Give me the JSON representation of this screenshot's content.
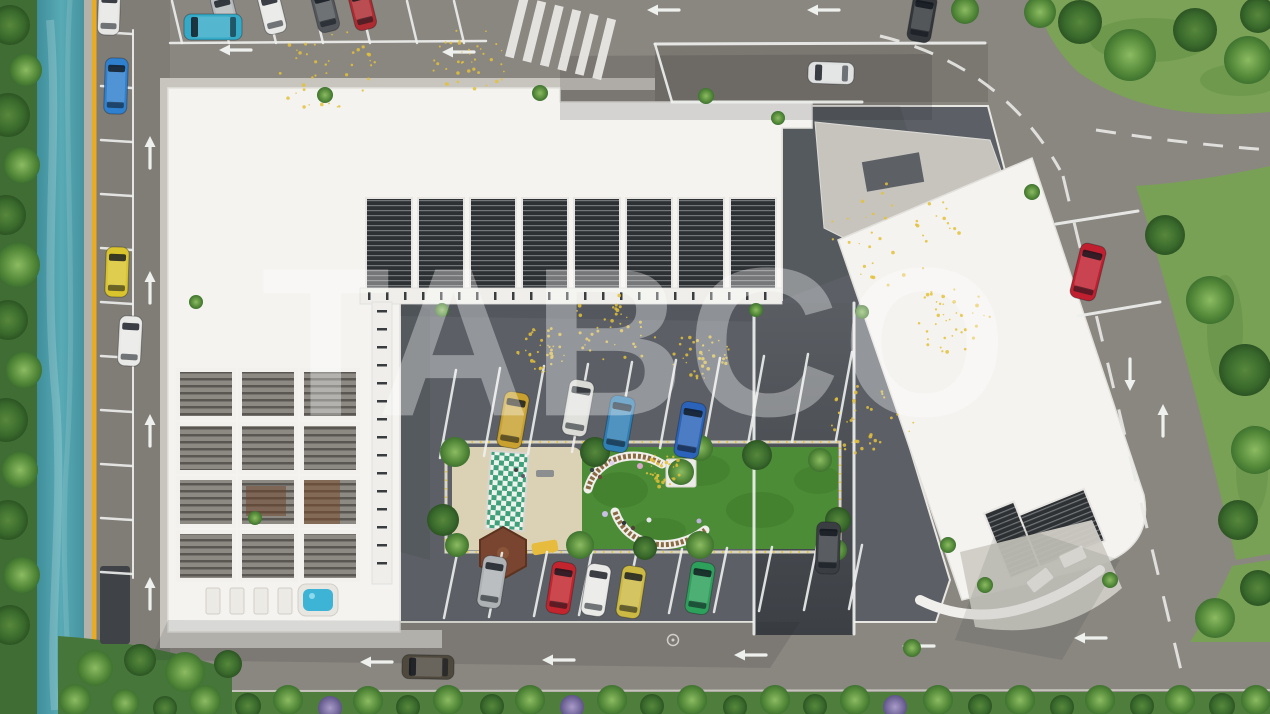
{
  "watermark": {
    "text": "TABCO"
  },
  "scene": {
    "description": "Aerial 3D architectural rendering: white residential complex with rooftop pergolas, inner courtyard parking, playground and garden, bordered by roads, a teal canal and greenery",
    "palette": {
      "road": "#8a8680",
      "courtyard_asphalt": "#5c6066",
      "ramp": "#4c5055",
      "roof_white": "#f4f3f0",
      "apron": "#c8c5be",
      "slats_dark": "#33363a",
      "water": "#4796a3",
      "barrier_yellow": "#e8ab21",
      "grass": "#7ba257",
      "vegetation": "#47763a",
      "lawn": "#4c8c36",
      "sand": "#dbd1b4",
      "line_white": "#eef0ee",
      "bench_wood": "#8a6a42",
      "jacuzzi": "#3db4d6",
      "confetti_yellow": "#e3c139"
    },
    "cars": [
      {
        "name": "parked-car-silver-top",
        "color": "#b7babc",
        "x": 225,
        "y": 14,
        "rot": -14,
        "l": 44,
        "w": 22
      },
      {
        "name": "parked-car-white-top",
        "color": "#e8e8e6",
        "x": 272,
        "y": 12,
        "rot": -14,
        "l": 44,
        "w": 22
      },
      {
        "name": "parked-car-gray-top",
        "color": "#53575b",
        "x": 325,
        "y": 10,
        "rot": -14,
        "l": 44,
        "w": 22
      },
      {
        "name": "parked-car-red-top",
        "color": "#ad2b31",
        "x": 362,
        "y": 8,
        "rot": -14,
        "l": 44,
        "w": 22
      },
      {
        "name": "parked-car-teal-top",
        "color": "#35a9c6",
        "x": 213,
        "y": 27,
        "rot": -90,
        "l": 58,
        "w": 26
      },
      {
        "name": "parked-car-white-topleft",
        "color": "#e6e6e4",
        "x": 109,
        "y": 12,
        "rot": 2,
        "l": 46,
        "w": 22
      },
      {
        "name": "parked-car-blue-left",
        "color": "#2f80cf",
        "x": 116,
        "y": 86,
        "rot": 2,
        "l": 56,
        "w": 23
      },
      {
        "name": "parked-car-yellow-left",
        "color": "#d9c42e",
        "x": 117,
        "y": 272,
        "rot": 2,
        "l": 50,
        "w": 23
      },
      {
        "name": "driving-car-white-left",
        "color": "#e9e9e7",
        "x": 130,
        "y": 341,
        "rot": 3,
        "l": 50,
        "w": 23
      },
      {
        "name": "driving-car-white-driveway",
        "color": "#dfe1e1",
        "x": 831,
        "y": 73,
        "rot": -88,
        "l": 46,
        "w": 22
      },
      {
        "name": "driving-suv-black-topright",
        "color": "#33373b",
        "x": 922,
        "y": 18,
        "rot": 10,
        "l": 48,
        "w": 24
      },
      {
        "name": "parked-car-red-right",
        "color": "#c01f2f",
        "x": 1088,
        "y": 272,
        "rot": 14,
        "l": 56,
        "w": 26
      },
      {
        "name": "driving-car-black-ramp",
        "color": "#3a3e43",
        "x": 828,
        "y": 548,
        "rot": 2,
        "l": 52,
        "w": 24
      },
      {
        "name": "driving-car-bronze-bottom",
        "color": "#4e483d",
        "x": 428,
        "y": 667,
        "rot": -89,
        "l": 52,
        "w": 24
      },
      {
        "name": "parked-car-gold-courtyard",
        "color": "#c8a130",
        "x": 513,
        "y": 420,
        "rot": 10,
        "l": 56,
        "w": 25
      },
      {
        "name": "parked-car-white-courtyard",
        "color": "#dadbd6",
        "x": 578,
        "y": 408,
        "rot": 10,
        "l": 56,
        "w": 25
      },
      {
        "name": "parked-car-steelblue-courtyard",
        "color": "#2f7fb4",
        "x": 619,
        "y": 424,
        "rot": 10,
        "l": 56,
        "w": 25
      },
      {
        "name": "parked-car-blue-courtyard",
        "color": "#2a63b9",
        "x": 690,
        "y": 430,
        "rot": 10,
        "l": 56,
        "w": 25
      },
      {
        "name": "parked-car-silver-courtyard",
        "color": "#aeb2b4",
        "x": 492,
        "y": 582,
        "rot": 9,
        "l": 52,
        "w": 24
      },
      {
        "name": "parked-car-red-courtyard",
        "color": "#c2252e",
        "x": 561,
        "y": 588,
        "rot": 9,
        "l": 52,
        "w": 24
      },
      {
        "name": "parked-car-white2-courtyard",
        "color": "#e9e9e7",
        "x": 596,
        "y": 590,
        "rot": 9,
        "l": 52,
        "w": 24
      },
      {
        "name": "parked-car-yellow-courtyard",
        "color": "#ccb944",
        "x": 631,
        "y": 592,
        "rot": 9,
        "l": 52,
        "w": 24
      },
      {
        "name": "parked-car-green-courtyard",
        "color": "#2da05b",
        "x": 700,
        "y": 588,
        "rot": 9,
        "l": 52,
        "w": 24
      }
    ],
    "trees": [
      [
        10,
        25,
        20,
        "d"
      ],
      [
        26,
        70,
        16,
        "m"
      ],
      [
        8,
        115,
        22,
        "d"
      ],
      [
        22,
        165,
        18,
        "m"
      ],
      [
        6,
        215,
        20,
        "d"
      ],
      [
        18,
        265,
        22,
        "m"
      ],
      [
        8,
        320,
        20,
        "d"
      ],
      [
        24,
        370,
        18,
        "m"
      ],
      [
        6,
        420,
        22,
        "d"
      ],
      [
        20,
        470,
        18,
        "m"
      ],
      [
        8,
        520,
        20,
        "d"
      ],
      [
        22,
        575,
        18,
        "m"
      ],
      [
        10,
        625,
        20,
        "d"
      ],
      [
        95,
        668,
        18,
        "m"
      ],
      [
        140,
        660,
        16,
        "d"
      ],
      [
        185,
        672,
        20,
        "m"
      ],
      [
        228,
        664,
        14,
        "d"
      ],
      [
        75,
        700,
        16,
        "m"
      ],
      [
        125,
        703,
        14,
        "m"
      ],
      [
        165,
        708,
        12,
        "d"
      ],
      [
        205,
        701,
        16,
        "m"
      ],
      [
        248,
        706,
        13,
        "d"
      ],
      [
        288,
        700,
        15,
        "m"
      ],
      [
        330,
        708,
        12,
        "p"
      ],
      [
        368,
        701,
        15,
        "m"
      ],
      [
        408,
        707,
        12,
        "d"
      ],
      [
        448,
        700,
        15,
        "m"
      ],
      [
        492,
        706,
        12,
        "d"
      ],
      [
        530,
        700,
        15,
        "m"
      ],
      [
        572,
        707,
        12,
        "p"
      ],
      [
        612,
        700,
        15,
        "m"
      ],
      [
        652,
        706,
        12,
        "d"
      ],
      [
        692,
        700,
        15,
        "m"
      ],
      [
        735,
        707,
        12,
        "d"
      ],
      [
        775,
        700,
        15,
        "m"
      ],
      [
        815,
        706,
        12,
        "d"
      ],
      [
        855,
        700,
        15,
        "m"
      ],
      [
        895,
        707,
        12,
        "p"
      ],
      [
        938,
        700,
        15,
        "m"
      ],
      [
        980,
        706,
        12,
        "d"
      ],
      [
        1020,
        700,
        15,
        "m"
      ],
      [
        1062,
        707,
        12,
        "d"
      ],
      [
        1100,
        700,
        15,
        "m"
      ],
      [
        1142,
        706,
        12,
        "d"
      ],
      [
        1180,
        700,
        15,
        "m"
      ],
      [
        1222,
        706,
        13,
        "d"
      ],
      [
        1256,
        700,
        15,
        "m"
      ],
      [
        1040,
        12,
        16,
        "m"
      ],
      [
        1080,
        22,
        22,
        "d"
      ],
      [
        1130,
        55,
        26,
        "m"
      ],
      [
        1195,
        30,
        22,
        "d"
      ],
      [
        1248,
        60,
        24,
        "m"
      ],
      [
        1258,
        15,
        18,
        "d"
      ],
      [
        965,
        10,
        14,
        "m"
      ],
      [
        1165,
        235,
        20,
        "d"
      ],
      [
        1210,
        300,
        24,
        "m"
      ],
      [
        1245,
        370,
        26,
        "d"
      ],
      [
        1255,
        450,
        24,
        "m"
      ],
      [
        1238,
        520,
        20,
        "d"
      ],
      [
        1215,
        618,
        20,
        "m"
      ],
      [
        1258,
        588,
        18,
        "d"
      ],
      [
        455,
        452,
        15,
        "m"
      ],
      [
        443,
        520,
        16,
        "d"
      ],
      [
        457,
        545,
        12,
        "m"
      ],
      [
        595,
        452,
        15,
        "d"
      ],
      [
        580,
        545,
        14,
        "m"
      ],
      [
        700,
        448,
        13,
        "m"
      ],
      [
        757,
        455,
        15,
        "d"
      ],
      [
        820,
        460,
        12,
        "m"
      ],
      [
        838,
        520,
        13,
        "d"
      ],
      [
        700,
        545,
        14,
        "m"
      ],
      [
        645,
        548,
        12,
        "d"
      ],
      [
        836,
        550,
        11,
        "m"
      ],
      [
        325,
        95,
        8,
        "m"
      ],
      [
        540,
        93,
        8,
        "m"
      ],
      [
        706,
        96,
        8,
        "m"
      ],
      [
        778,
        118,
        7,
        "m"
      ],
      [
        196,
        302,
        7,
        "m"
      ],
      [
        442,
        310,
        7,
        "m"
      ],
      [
        255,
        518,
        7,
        "m"
      ],
      [
        1032,
        192,
        8,
        "m"
      ],
      [
        948,
        545,
        8,
        "m"
      ],
      [
        912,
        648,
        9,
        "m"
      ],
      [
        756,
        310,
        7,
        "m"
      ],
      [
        862,
        312,
        7,
        "m"
      ],
      [
        985,
        585,
        8,
        "m"
      ],
      [
        1110,
        580,
        8,
        "m"
      ]
    ],
    "arrows": [
      {
        "x": 235,
        "y": 50,
        "dir": "left"
      },
      {
        "x": 458,
        "y": 52,
        "dir": "left"
      },
      {
        "x": 663,
        "y": 10,
        "dir": "left"
      },
      {
        "x": 823,
        "y": 10,
        "dir": "left"
      },
      {
        "x": 376,
        "y": 662,
        "dir": "left"
      },
      {
        "x": 558,
        "y": 660,
        "dir": "left"
      },
      {
        "x": 750,
        "y": 655,
        "dir": "left"
      },
      {
        "x": 918,
        "y": 646,
        "dir": "left"
      },
      {
        "x": 1090,
        "y": 638,
        "dir": "left"
      },
      {
        "x": 150,
        "y": 152,
        "dir": "up"
      },
      {
        "x": 150,
        "y": 287,
        "dir": "up"
      },
      {
        "x": 150,
        "y": 430,
        "dir": "up"
      },
      {
        "x": 150,
        "y": 593,
        "dir": "up"
      },
      {
        "x": 1163,
        "y": 420,
        "dir": "up"
      },
      {
        "x": 1130,
        "y": 375,
        "dir": "down"
      }
    ],
    "parking_rows": [
      {
        "name": "top-street-bays",
        "x0": 172,
        "y0": 1,
        "sx": 47,
        "sy": 0,
        "vx": 10,
        "vy": 42,
        "n": 7
      },
      {
        "name": "canal-street-bays",
        "x0": 101,
        "y0": 32,
        "sx": 0,
        "sy": 54,
        "vx": 31,
        "vy": 2,
        "n": 11
      },
      {
        "name": "courtyard-upper-bays",
        "x0": 440,
        "y0": 458,
        "sx": 44,
        "sy": -2,
        "vx": 16,
        "vy": -88,
        "n": 10
      },
      {
        "name": "courtyard-lower-bays",
        "x0": 444,
        "y0": 618,
        "sx": 45,
        "sy": -1,
        "vx": 13,
        "vy": -64,
        "n": 10
      }
    ],
    "lane_lines": [
      [
        170,
        43,
        486,
        41,
        2.5
      ],
      [
        133,
        30,
        133,
        578,
        2
      ],
      [
        1056,
        224,
        1138,
        211,
        3
      ],
      [
        1078,
        316,
        1160,
        302,
        3
      ],
      [
        655,
        44,
        985,
        43,
        3
      ],
      [
        672,
        102,
        862,
        102,
        3
      ],
      [
        655,
        44,
        672,
        102,
        2.5
      ],
      [
        754,
        303,
        754,
        634,
        3
      ],
      [
        854,
        303,
        854,
        634,
        3
      ]
    ],
    "dashed_paths": [
      {
        "d": "M880,36 Q1002,66 1060,170",
        "dash": "20 16",
        "w": 3
      },
      {
        "d": "M1063,176 L1190,708",
        "dash": "26 22",
        "w": 3
      },
      {
        "d": "M1096,130 Q1186,144 1270,150",
        "dash": "20 16",
        "w": 3
      }
    ],
    "zebra": {
      "x": 520,
      "y": -4,
      "rot": 14,
      "n": 6,
      "w": 9,
      "h": 62,
      "gap": 9
    },
    "speckle_clusters": [
      [
        330,
        70,
        55
      ],
      [
        470,
        60,
        40
      ],
      [
        610,
        330,
        48
      ],
      [
        895,
        235,
        65
      ],
      [
        950,
        320,
        42
      ],
      [
        700,
        355,
        30
      ],
      [
        870,
        420,
        45
      ],
      [
        545,
        350,
        28
      ],
      [
        660,
        470,
        22
      ]
    ],
    "road_marking_circle": {
      "x": 673,
      "y": 640,
      "r": 5.5
    }
  }
}
